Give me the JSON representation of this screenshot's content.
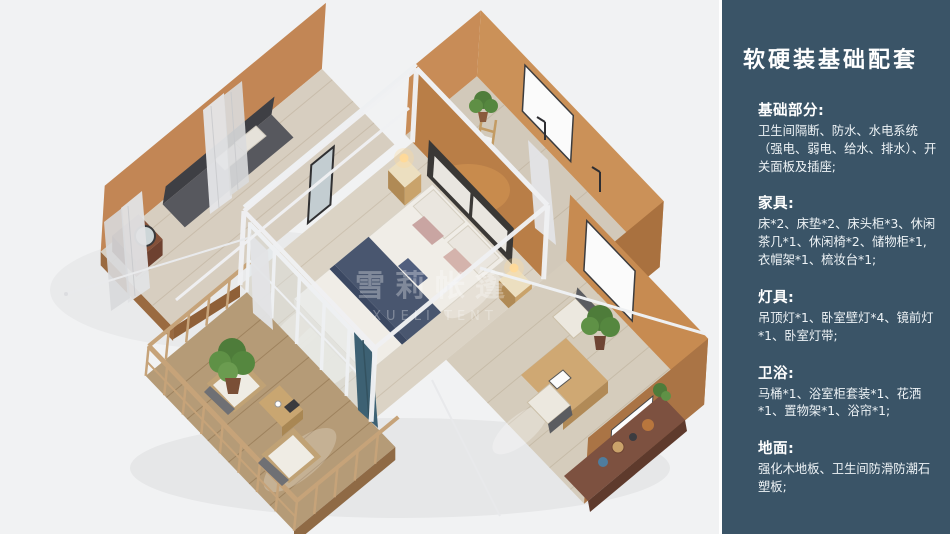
{
  "page": {
    "bg_color": "#f1f2f3",
    "type_label": "interior-floorplan-render-slide"
  },
  "sidebar": {
    "bg_color": "#3a5467",
    "title": "软硬装基础配套",
    "sections": [
      {
        "heading": "基础部分:",
        "body": "卫生间隔断、防水、水电系统（强电、弱电、给水、排水）、开关面板及插座;"
      },
      {
        "heading": "家具:",
        "body": "床*2、床垫*2、床头柜*3、休闲茶几*1、休闲椅*2、储物柜*1, 衣帽架*1、梳妆台*1;"
      },
      {
        "heading": "灯具:",
        "body": "吊顶灯*1、卧室壁灯*4、镜前灯*1、卧室灯带;"
      },
      {
        "heading": "卫浴:",
        "body": "马桶*1、浴室柜套装*1、花洒*1、置物架*1、浴帘*1;"
      },
      {
        "heading": "地面:",
        "body": "强化木地板、卫生间防滑防潮石塑板;"
      }
    ]
  },
  "render": {
    "watermark_line1": "雪莉帐篷",
    "watermark_line2": "XUELI TENT",
    "palette": {
      "wall_tan": "#c28655",
      "wall_dark": "#a9713f",
      "floor_wood": "#dbd3c5",
      "deck_wood": "#b59b77",
      "bedding_navy": "#49566f",
      "steel_frame_white": "#eef0f2",
      "curtain_teal": "#3d6173"
    }
  }
}
